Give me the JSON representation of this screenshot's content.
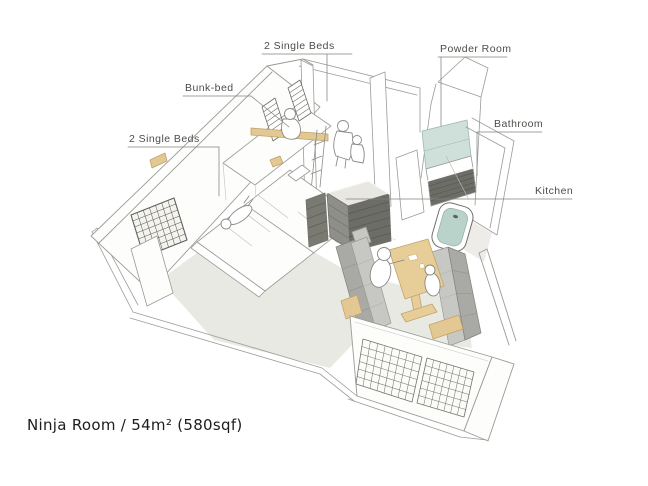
{
  "title": {
    "text": "Ninja Room / 54m² (580sqf)"
  },
  "labels": {
    "single_beds_top": "2 Single Beds",
    "bunk_bed": "Bunk-bed",
    "single_beds_left": "2 Single Beds",
    "powder_room": "Powder Room",
    "bathroom": "Bathroom",
    "kitchen": "Kitchen"
  },
  "illustration": {
    "kind": "hand-drawn axonometric apartment sketch",
    "depicted_elements": [
      "two single beds with lying figure",
      "bunk bed with wooden rail, ladder and striped pillows",
      "dark lattice window on left wall",
      "powder room with mirror and dark vanity",
      "bathroom with bathtub",
      "kitchen counter island",
      "dining table with two seated figures",
      "two gray bench sofas on wooden bases",
      "large balcony lattice windows"
    ],
    "colors": {
      "line": "#9a9a96",
      "wood_accent": "#e3c893",
      "sofa_gray": "#a9a9a5",
      "water_blue": "#b9d2ca",
      "mirror_blue": "#cfe0da",
      "dark_counter": "#6d6d67",
      "floor_tint": "#e9e9e4"
    }
  }
}
